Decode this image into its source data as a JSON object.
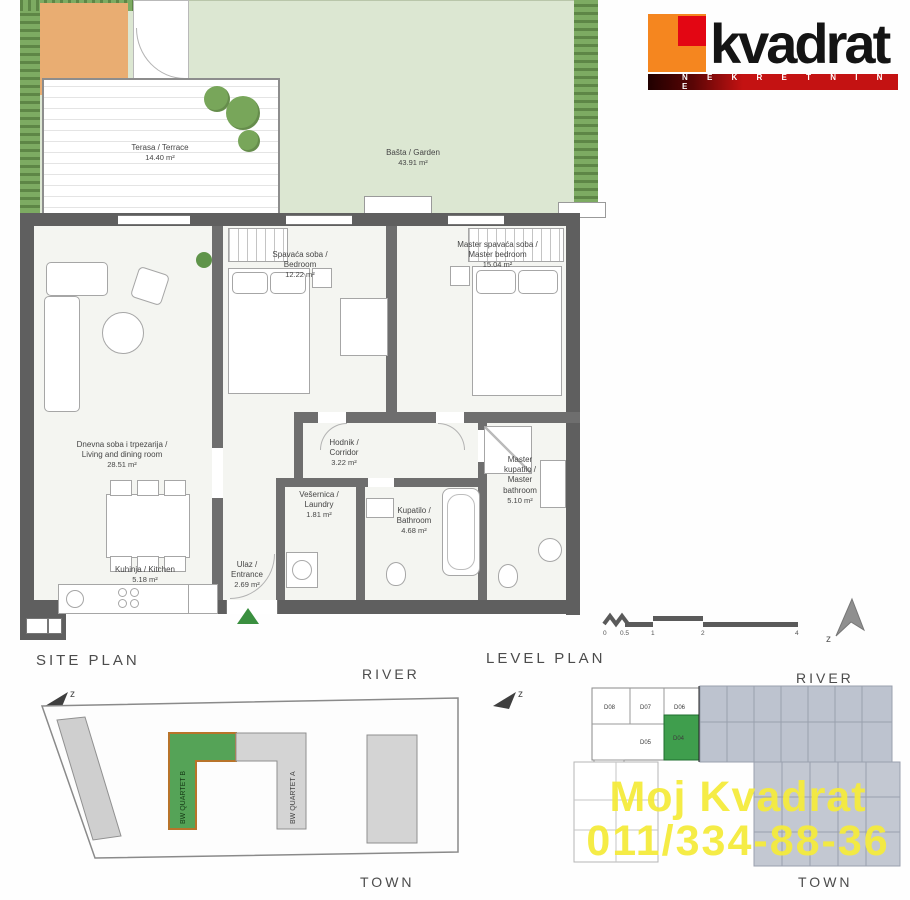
{
  "logo": {
    "brand": "kvadrat",
    "tagline": "N E K R E T N I N E"
  },
  "plan": {
    "terrace": {
      "name": "Terasa / Terrace",
      "area": "14.40 m²"
    },
    "garden": {
      "name": "Bašta / Garden",
      "area": "43.91 m²"
    },
    "bedroom": {
      "l1": "Spavaća soba /",
      "l2": "Bedroom",
      "area": "12.22 m²"
    },
    "master_bedroom": {
      "l1": "Master spavaća soba /",
      "l2": "Master bedroom",
      "area": "15.04 m²"
    },
    "living": {
      "l1": "Dnevna soba i trpezarija /",
      "l2": "Living and dining room",
      "area": "28.51 m²"
    },
    "corridor": {
      "l1": "Hodnik /",
      "l2": "Corridor",
      "area": "3.22 m²"
    },
    "laundry": {
      "l1": "Vešernica /",
      "l2": "Laundry",
      "area": "1.81 m²"
    },
    "bathroom": {
      "l1": "Kupatilo /",
      "l2": "Bathroom",
      "area": "4.68 m²"
    },
    "master_bathroom": {
      "l1": "Master",
      "l2": "kupatilo /",
      "l3": "Master",
      "l4": "bathroom",
      "area": "5.10 m²"
    },
    "kitchen": {
      "l1": "Kuhinja / Kitchen",
      "area": "5.18 m²"
    },
    "entrance": {
      "l1": "Ulaz /",
      "l2": "Entrance",
      "area": "2.69 m²"
    }
  },
  "site_plan": {
    "title": "SITE PLAN",
    "river": "RIVER",
    "town": "TOWN",
    "building_b": "BW QUARTET B",
    "building_a": "BW QUARTET A",
    "compass": "z"
  },
  "level_plan": {
    "title": "LEVEL PLAN",
    "river": "RIVER",
    "town": "TOWN",
    "compass": "z",
    "units": {
      "u08": "D08",
      "u07": "D07",
      "u06": "D06",
      "u05": "D05",
      "u04": "D04",
      "u03": "D03",
      "u02": "D02",
      "u01": "D01"
    },
    "highlighted_unit": "D04",
    "scale": {
      "t0": "0",
      "t05": "0.5",
      "t1": "1",
      "t2": "2",
      "t4": "4"
    }
  },
  "watermark": {
    "line1": "Moj Kvadrat",
    "line2": "011/334-88-36"
  },
  "colors": {
    "logo_orange": "#f5861f",
    "logo_red": "#e30613",
    "bar_red": "#c41212",
    "garden": "#dce7d2",
    "hedge": "#72a455",
    "wall": "#5f5f5f",
    "floor": "#f4f5f1",
    "site_building_green": "#55a357",
    "site_building_border": "#b8742a",
    "unit_green": "#3f9e4d",
    "level_shade": "#bdc3cf",
    "watermark_yellow": "#f2e93e",
    "entrance_marker_green": "#3a8f3f"
  }
}
